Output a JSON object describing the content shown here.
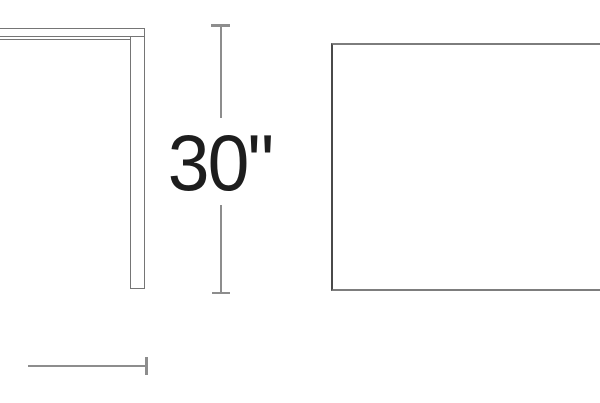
{
  "drawing": {
    "subject": "table-dimension-line-drawing",
    "height_dimension": {
      "label": "30\"",
      "orientation": "vertical"
    },
    "depth_dimension": {
      "label": "",
      "orientation": "horizontal"
    },
    "colors": {
      "background": "#ffffff",
      "dimension_line": "#8d8d8d",
      "drawing_outline": "#757575",
      "plan_edge": "#7d7d7d",
      "plan_edge_dark": "#4a4a4a",
      "label_text": "#1d1d1d"
    }
  }
}
